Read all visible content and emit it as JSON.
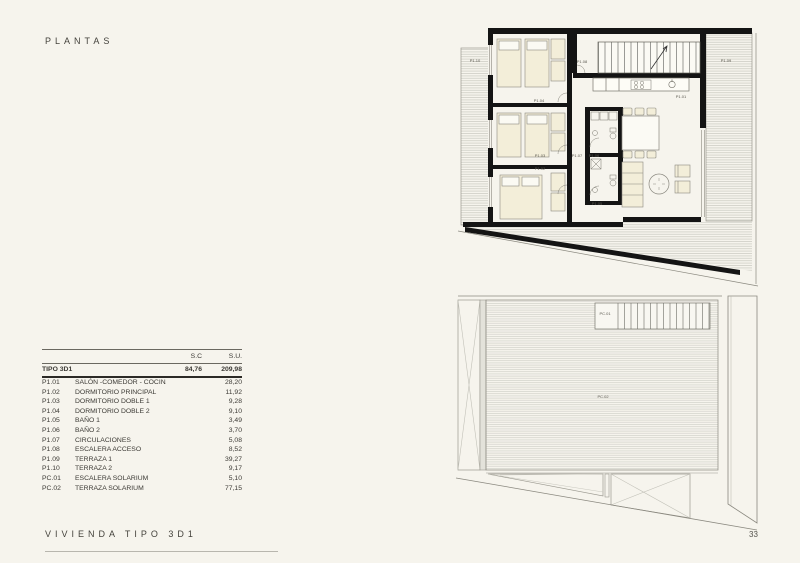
{
  "page": {
    "title": "PLANTAS",
    "footer": "VIVIENDA TIPO 3D1",
    "page_number": "33"
  },
  "area_table": {
    "headers": {
      "sc": "S.C",
      "su": "S.U."
    },
    "summary": {
      "code": "TIPO 3D1",
      "sc": "84,76",
      "su": "209,98"
    },
    "rows": [
      {
        "code": "P1.01",
        "name": "SALÓN -COMEDOR - COCINA",
        "su": "28,20"
      },
      {
        "code": "P1.02",
        "name": "DORMITORIO PRINCIPAL",
        "su": "11,92"
      },
      {
        "code": "P1.03",
        "name": "DORMITORIO DOBLE 1",
        "su": "9,28"
      },
      {
        "code": "P1.04",
        "name": "DORMITORIO DOBLE 2",
        "su": "9,10"
      },
      {
        "code": "P1.05",
        "name": "BAÑO 1",
        "su": "3,49"
      },
      {
        "code": "P1.06",
        "name": "BAÑO 2",
        "su": "3,70"
      },
      {
        "code": "P1.07",
        "name": "CIRCULACIONES",
        "su": "5,08"
      },
      {
        "code": "P1.08",
        "name": "ESCALERA ACCESO",
        "su": "8,52"
      },
      {
        "code": "P1.09",
        "name": "TERRAZA 1",
        "su": "39,27"
      },
      {
        "code": "P1.10",
        "name": "TERRAZA 2",
        "su": "9,17"
      },
      {
        "code": "PC.01",
        "name": "ESCALERA SOLARIUM",
        "su": "5,10"
      },
      {
        "code": "PC.02",
        "name": "TERRAZA SOLARIUM",
        "su": "77,15"
      }
    ]
  },
  "plan_upper": {
    "labels": {
      "p101": "P1.01",
      "p102": "P1.02",
      "p103": "P1.03",
      "p104": "P1.04",
      "p105": "P1.05",
      "p106": "P1.06",
      "p107": "P1.07",
      "p108": "P1.08",
      "p109": "P1.09",
      "p110": "P1.10"
    }
  },
  "plan_lower": {
    "labels": {
      "pc01": "PC.01",
      "pc02": "PC.02"
    }
  },
  "colors": {
    "paper": "#f6f4ed",
    "wall_ink": "#141414",
    "thin_line": "#8a887f",
    "furniture_fill": "#f3eed9",
    "hatch_line": "#c9c8c0"
  }
}
